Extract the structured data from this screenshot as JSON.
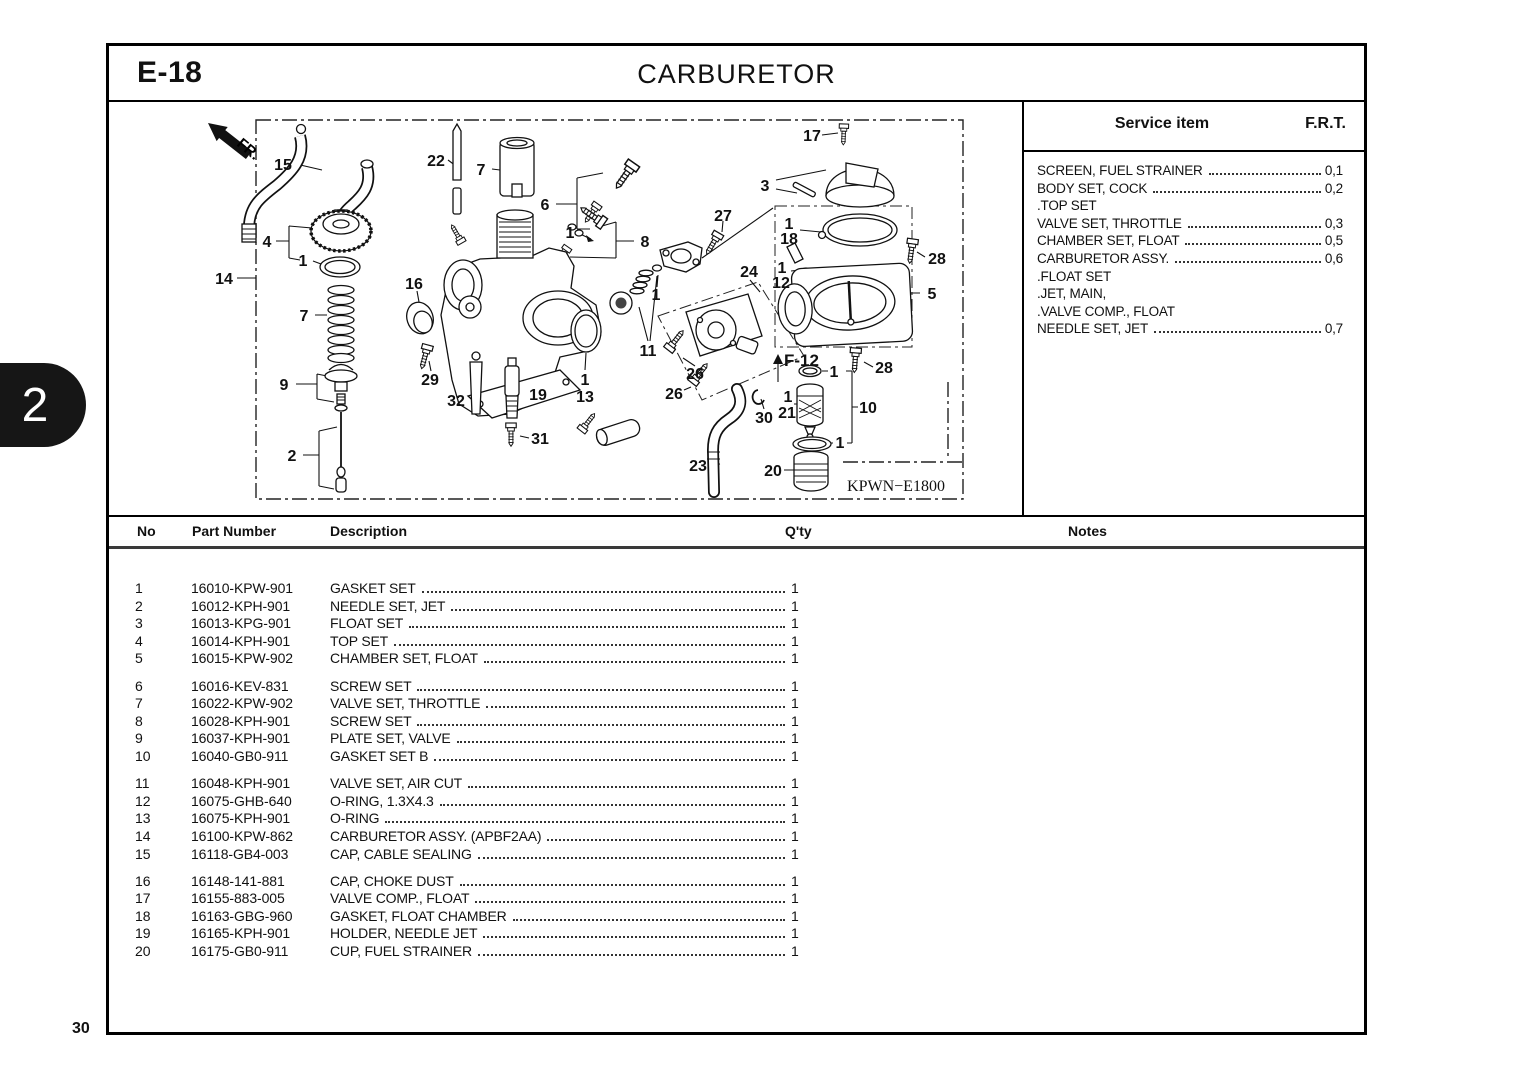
{
  "page": {
    "code": "E-18",
    "title": "CARBURETOR",
    "page_number": "30",
    "section_tab": "2"
  },
  "service_panel": {
    "col_item": "Service item",
    "col_frt": "F.R.T.",
    "items": [
      {
        "name": "SCREEN, FUEL STRAINER",
        "frt": "0,1"
      },
      {
        "name": "BODY SET, COCK",
        "frt": "0,2"
      },
      {
        "name": ".TOP SET",
        "frt": ""
      },
      {
        "name": "VALVE SET, THROTTLE",
        "frt": "0,3"
      },
      {
        "name": "CHAMBER SET, FLOAT",
        "frt": "0,5"
      },
      {
        "name": "CARBURETOR ASSY.",
        "frt": "0,6"
      },
      {
        "name": ".FLOAT SET",
        "frt": ""
      },
      {
        "name": ".JET, MAIN,",
        "frt": ""
      },
      {
        "name": ".VALVE COMP., FLOAT",
        "frt": ""
      },
      {
        "name": "NEEDLE SET, JET",
        "frt": "0,7"
      }
    ]
  },
  "diagram": {
    "figure_code": "KPWN−E1800",
    "inset_ref": "F-12",
    "direction": "FR.",
    "callouts": [
      {
        "label": "15",
        "x": 283,
        "y": 164
      },
      {
        "label": "22",
        "x": 436,
        "y": 160
      },
      {
        "label": "7",
        "x": 481,
        "y": 169
      },
      {
        "label": "6",
        "x": 545,
        "y": 204
      },
      {
        "label": "1",
        "x": 570,
        "y": 232
      },
      {
        "label": "8",
        "x": 645,
        "y": 241
      },
      {
        "label": "27",
        "x": 723,
        "y": 215
      },
      {
        "label": "17",
        "x": 812,
        "y": 135
      },
      {
        "label": "3",
        "x": 765,
        "y": 185
      },
      {
        "label": "4",
        "x": 267,
        "y": 241
      },
      {
        "label": "1",
        "x": 303,
        "y": 260
      },
      {
        "label": "14",
        "x": 224,
        "y": 278
      },
      {
        "label": "16",
        "x": 414,
        "y": 283
      },
      {
        "label": "7",
        "x": 304,
        "y": 315
      },
      {
        "label": "9",
        "x": 284,
        "y": 384
      },
      {
        "label": "29",
        "x": 430,
        "y": 379
      },
      {
        "label": "32",
        "x": 456,
        "y": 400
      },
      {
        "label": "19",
        "x": 538,
        "y": 394
      },
      {
        "label": "31",
        "x": 540,
        "y": 438
      },
      {
        "label": "2",
        "x": 292,
        "y": 455
      },
      {
        "label": "1",
        "x": 585,
        "y": 379
      },
      {
        "label": "13",
        "x": 585,
        "y": 396
      },
      {
        "label": "11",
        "x": 648,
        "y": 350
      },
      {
        "label": "1",
        "x": 656,
        "y": 294
      },
      {
        "label": "24",
        "x": 749,
        "y": 271
      },
      {
        "label": "26",
        "x": 695,
        "y": 373
      },
      {
        "label": "26",
        "x": 674,
        "y": 393
      },
      {
        "label": "30",
        "x": 764,
        "y": 417
      },
      {
        "label": "1",
        "x": 788,
        "y": 396
      },
      {
        "label": "21",
        "x": 787,
        "y": 412
      },
      {
        "label": "23",
        "x": 698,
        "y": 465
      },
      {
        "label": "20",
        "x": 773,
        "y": 470
      },
      {
        "label": "1",
        "x": 840,
        "y": 442
      },
      {
        "label": "10",
        "x": 868,
        "y": 407
      },
      {
        "label": "1",
        "x": 834,
        "y": 371
      },
      {
        "label": "28",
        "x": 884,
        "y": 367
      },
      {
        "label": "28",
        "x": 937,
        "y": 258
      },
      {
        "label": "5",
        "x": 932,
        "y": 293
      },
      {
        "label": "1",
        "x": 789,
        "y": 223
      },
      {
        "label": "18",
        "x": 789,
        "y": 238
      },
      {
        "label": "1",
        "x": 782,
        "y": 267
      },
      {
        "label": "12",
        "x": 781,
        "y": 282
      }
    ]
  },
  "parts_table": {
    "headers": {
      "no": "No",
      "part": "Part Number",
      "desc": "Description",
      "qty": "Q'ty",
      "notes": "Notes"
    },
    "groups": [
      [
        {
          "no": "1",
          "part": "16010-KPW-901",
          "desc": "GASKET SET",
          "qty": "1"
        },
        {
          "no": "2",
          "part": "16012-KPH-901",
          "desc": "NEEDLE SET, JET",
          "qty": "1"
        },
        {
          "no": "3",
          "part": "16013-KPG-901",
          "desc": "FLOAT SET",
          "qty": "1"
        },
        {
          "no": "4",
          "part": "16014-KPH-901",
          "desc": "TOP SET",
          "qty": "1"
        },
        {
          "no": "5",
          "part": "16015-KPW-902",
          "desc": "CHAMBER SET, FLOAT",
          "qty": "1"
        }
      ],
      [
        {
          "no": "6",
          "part": "16016-KEV-831",
          "desc": "SCREW SET",
          "qty": "1"
        },
        {
          "no": "7",
          "part": "16022-KPW-902",
          "desc": "VALVE SET, THROTTLE",
          "qty": "1"
        },
        {
          "no": "8",
          "part": "16028-KPH-901",
          "desc": "SCREW SET",
          "qty": "1"
        },
        {
          "no": "9",
          "part": "16037-KPH-901",
          "desc": "PLATE SET, VALVE",
          "qty": "1"
        },
        {
          "no": "10",
          "part": "16040-GB0-911",
          "desc": "GASKET SET B",
          "qty": "1"
        }
      ],
      [
        {
          "no": "11",
          "part": "16048-KPH-901",
          "desc": "VALVE SET, AIR CUT",
          "qty": "1"
        },
        {
          "no": "12",
          "part": "16075-GHB-640",
          "desc": "O-RING, 1.3X4.3",
          "qty": "1"
        },
        {
          "no": "13",
          "part": "16075-KPH-901",
          "desc": "O-RING",
          "qty": "1"
        },
        {
          "no": "14",
          "part": "16100-KPW-862",
          "desc": "CARBURETOR ASSY. (APBF2AA)",
          "qty": "1"
        },
        {
          "no": "15",
          "part": "16118-GB4-003",
          "desc": "CAP, CABLE SEALING",
          "qty": "1"
        }
      ],
      [
        {
          "no": "16",
          "part": "16148-141-881",
          "desc": "CAP, CHOKE DUST",
          "qty": "1"
        },
        {
          "no": "17",
          "part": "16155-883-005",
          "desc": "VALVE COMP., FLOAT",
          "qty": "1"
        },
        {
          "no": "18",
          "part": "16163-GBG-960",
          "desc": "GASKET, FLOAT CHAMBER",
          "qty": "1"
        },
        {
          "no": "19",
          "part": "16165-KPH-901",
          "desc": "HOLDER, NEEDLE JET",
          "qty": "1"
        },
        {
          "no": "20",
          "part": "16175-GB0-911",
          "desc": "CUP, FUEL STRAINER",
          "qty": "1"
        }
      ]
    ]
  }
}
